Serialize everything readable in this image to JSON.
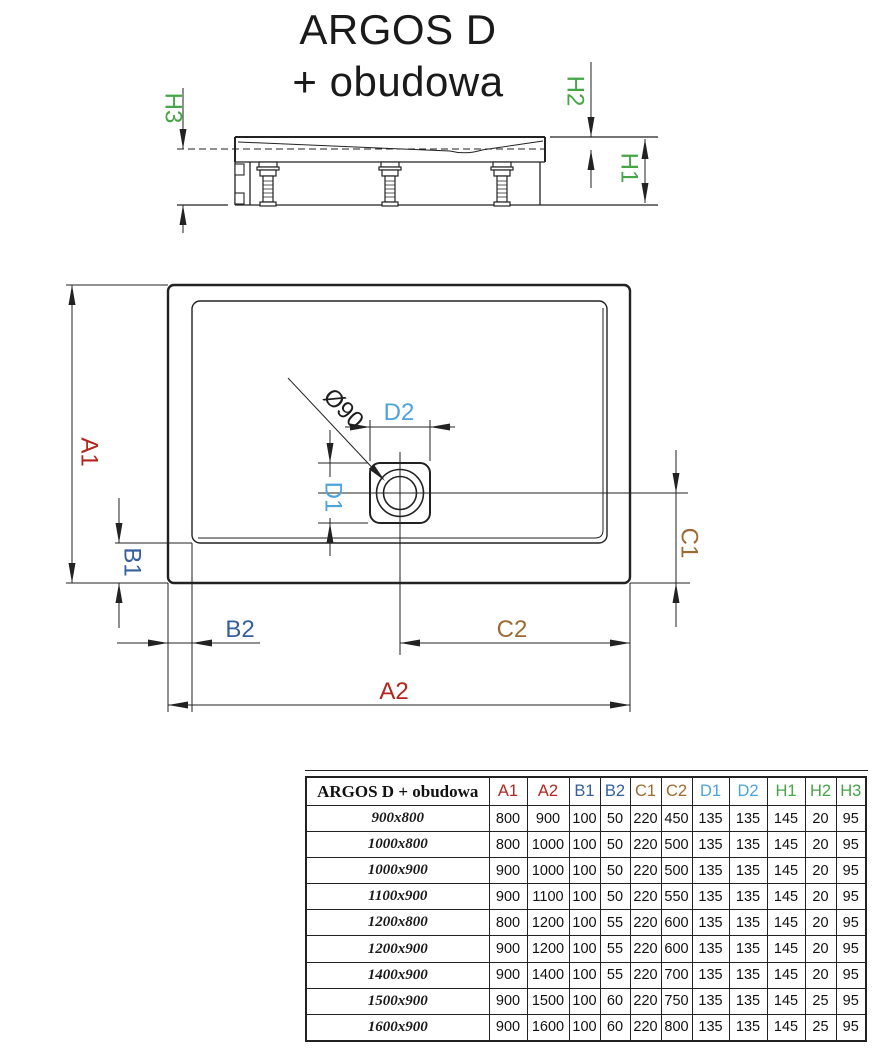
{
  "title": {
    "line1": "ARGOS D",
    "line2": "+ obudowa"
  },
  "colors": {
    "dim_a": "#b2261d",
    "dim_b": "#35609c",
    "dim_c": "#9c6b33",
    "dim_d": "#4da3dc",
    "dim_h": "#46a546",
    "line": "#222222"
  },
  "labels": {
    "a1": "A1",
    "a2": "A2",
    "b1": "B1",
    "b2": "B2",
    "c1": "C1",
    "c2": "C2",
    "d1": "D1",
    "d2": "D2",
    "h1": "H1",
    "h2": "H2",
    "h3": "H3",
    "diameter": "Ø90"
  },
  "table": {
    "header_label": "ARGOS D + obudowa",
    "columns": [
      {
        "label": "A1",
        "color": "dim_a"
      },
      {
        "label": "A2",
        "color": "dim_a"
      },
      {
        "label": "B1",
        "color": "dim_b"
      },
      {
        "label": "B2",
        "color": "dim_b"
      },
      {
        "label": "C1",
        "color": "dim_c"
      },
      {
        "label": "C2",
        "color": "dim_c"
      },
      {
        "label": "D1",
        "color": "dim_d"
      },
      {
        "label": "D2",
        "color": "dim_d"
      },
      {
        "label": "H1",
        "color": "dim_h"
      },
      {
        "label": "H2",
        "color": "dim_h"
      },
      {
        "label": "H3",
        "color": "dim_h"
      }
    ],
    "rows": [
      {
        "size": "900x800",
        "values": [
          800,
          900,
          100,
          50,
          220,
          450,
          135,
          135,
          145,
          20,
          95
        ]
      },
      {
        "size": "1000x800",
        "values": [
          800,
          1000,
          100,
          50,
          220,
          500,
          135,
          135,
          145,
          20,
          95
        ]
      },
      {
        "size": "1000x900",
        "values": [
          900,
          1000,
          100,
          50,
          220,
          500,
          135,
          135,
          145,
          20,
          95
        ]
      },
      {
        "size": "1100x900",
        "values": [
          900,
          1100,
          100,
          50,
          220,
          550,
          135,
          135,
          145,
          20,
          95
        ]
      },
      {
        "size": "1200x800",
        "values": [
          800,
          1200,
          100,
          55,
          220,
          600,
          135,
          135,
          145,
          20,
          95
        ]
      },
      {
        "size": "1200x900",
        "values": [
          900,
          1200,
          100,
          55,
          220,
          600,
          135,
          135,
          145,
          20,
          95
        ]
      },
      {
        "size": "1400x900",
        "values": [
          900,
          1400,
          100,
          55,
          220,
          700,
          135,
          135,
          145,
          20,
          95
        ]
      },
      {
        "size": "1500x900",
        "values": [
          900,
          1500,
          100,
          60,
          220,
          750,
          135,
          135,
          145,
          25,
          95
        ]
      },
      {
        "size": "1600x900",
        "values": [
          900,
          1600,
          100,
          60,
          220,
          800,
          135,
          135,
          145,
          25,
          95
        ]
      }
    ]
  }
}
